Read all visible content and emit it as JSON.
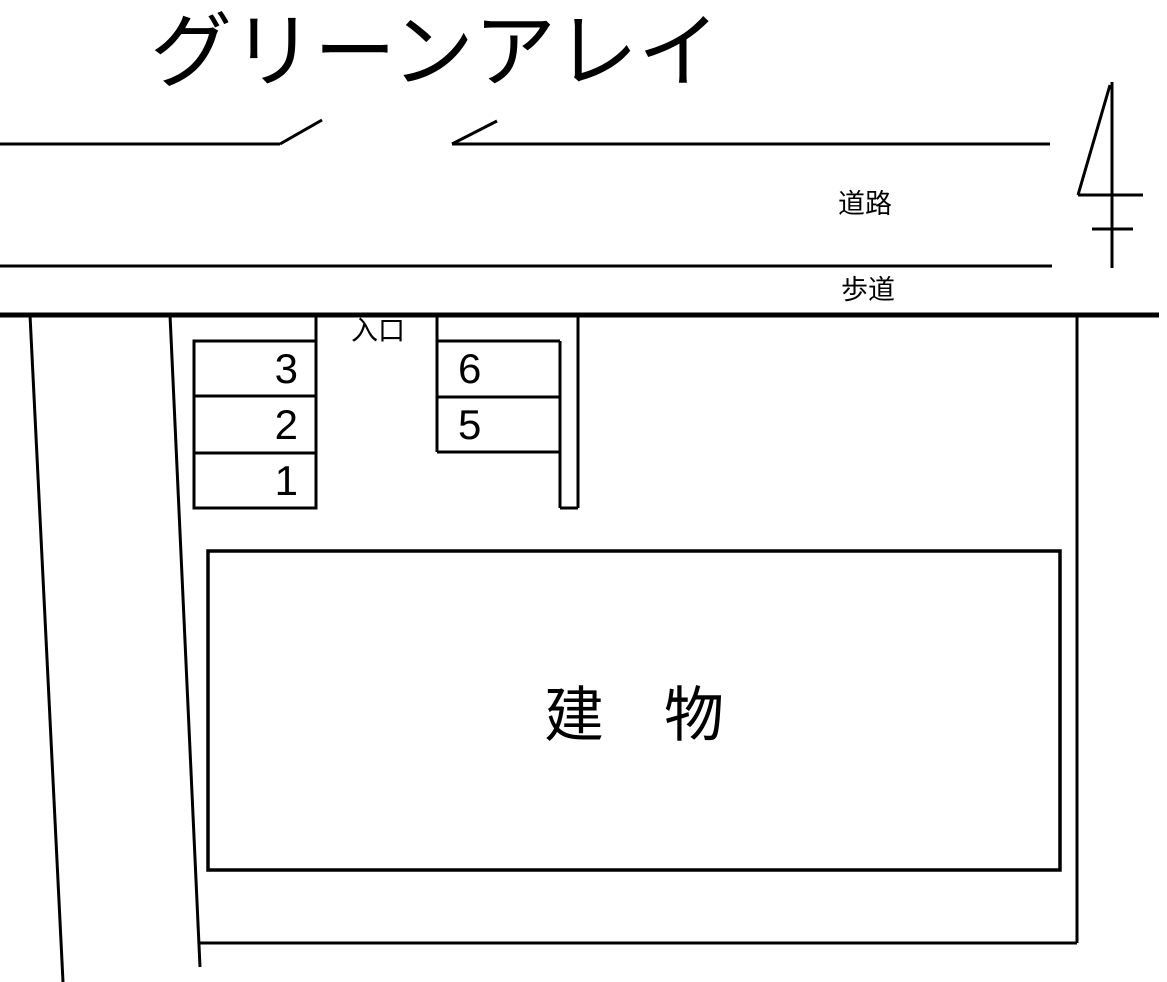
{
  "page": {
    "background_color": "#ffffff",
    "line_color": "#000000"
  },
  "title": "グリーンアレイ",
  "road": {
    "label": "道路"
  },
  "sidewalk": {
    "label": "歩道"
  },
  "entrance": {
    "label": "入口"
  },
  "building": {
    "label": "建　物"
  },
  "parking": {
    "left_column": [
      {
        "number": "3"
      },
      {
        "number": "2"
      },
      {
        "number": "1"
      }
    ],
    "right_column": [
      {
        "number": "6"
      },
      {
        "number": "5"
      }
    ]
  },
  "symbols": {
    "utility_pole": "utility-pole"
  }
}
